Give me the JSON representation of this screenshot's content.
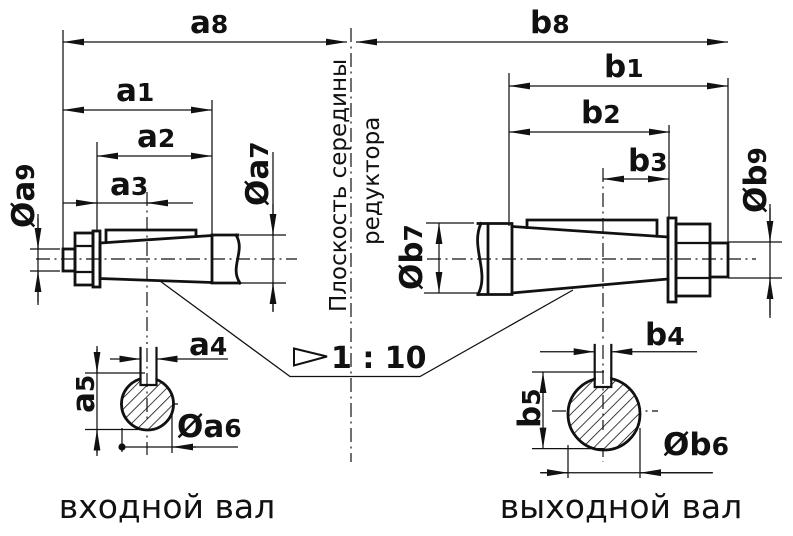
{
  "ink_color": "#111111",
  "background_color": "#ffffff",
  "labels": {
    "a1": {
      "letter": "a",
      "sub": "1"
    },
    "a2": {
      "letter": "a",
      "sub": "2"
    },
    "a3": {
      "letter": "a",
      "sub": "3"
    },
    "a4": {
      "letter": "a",
      "sub": "4"
    },
    "a5": {
      "letter": "a",
      "sub": "5"
    },
    "a6": {
      "pre": "Ø",
      "letter": "a",
      "sub": "6"
    },
    "a7": {
      "pre": "Ø",
      "letter": "a",
      "sub": "7"
    },
    "a8": {
      "letter": "a",
      "sub": "8"
    },
    "a9": {
      "pre": "Ø",
      "letter": "a",
      "sub": "9"
    },
    "b1": {
      "letter": "b",
      "sub": "1"
    },
    "b2": {
      "letter": "b",
      "sub": "2"
    },
    "b3": {
      "letter": "b",
      "sub": "3"
    },
    "b4": {
      "letter": "b",
      "sub": "4"
    },
    "b5": {
      "letter": "b",
      "sub": "5"
    },
    "b6": {
      "pre": "Ø",
      "letter": "b",
      "sub": "6"
    },
    "b7": {
      "pre": "Ø",
      "letter": "b",
      "sub": "7"
    },
    "b8": {
      "letter": "b",
      "sub": "8"
    },
    "b9": {
      "pre": "Ø",
      "letter": "b",
      "sub": "9"
    }
  },
  "center_plane": {
    "line1": "Плоскость середины",
    "line2": "редуктора"
  },
  "taper": {
    "ratio": "1 : 10"
  },
  "captions": {
    "input_shaft": "входной вал",
    "output_shaft": "выходной вал"
  }
}
